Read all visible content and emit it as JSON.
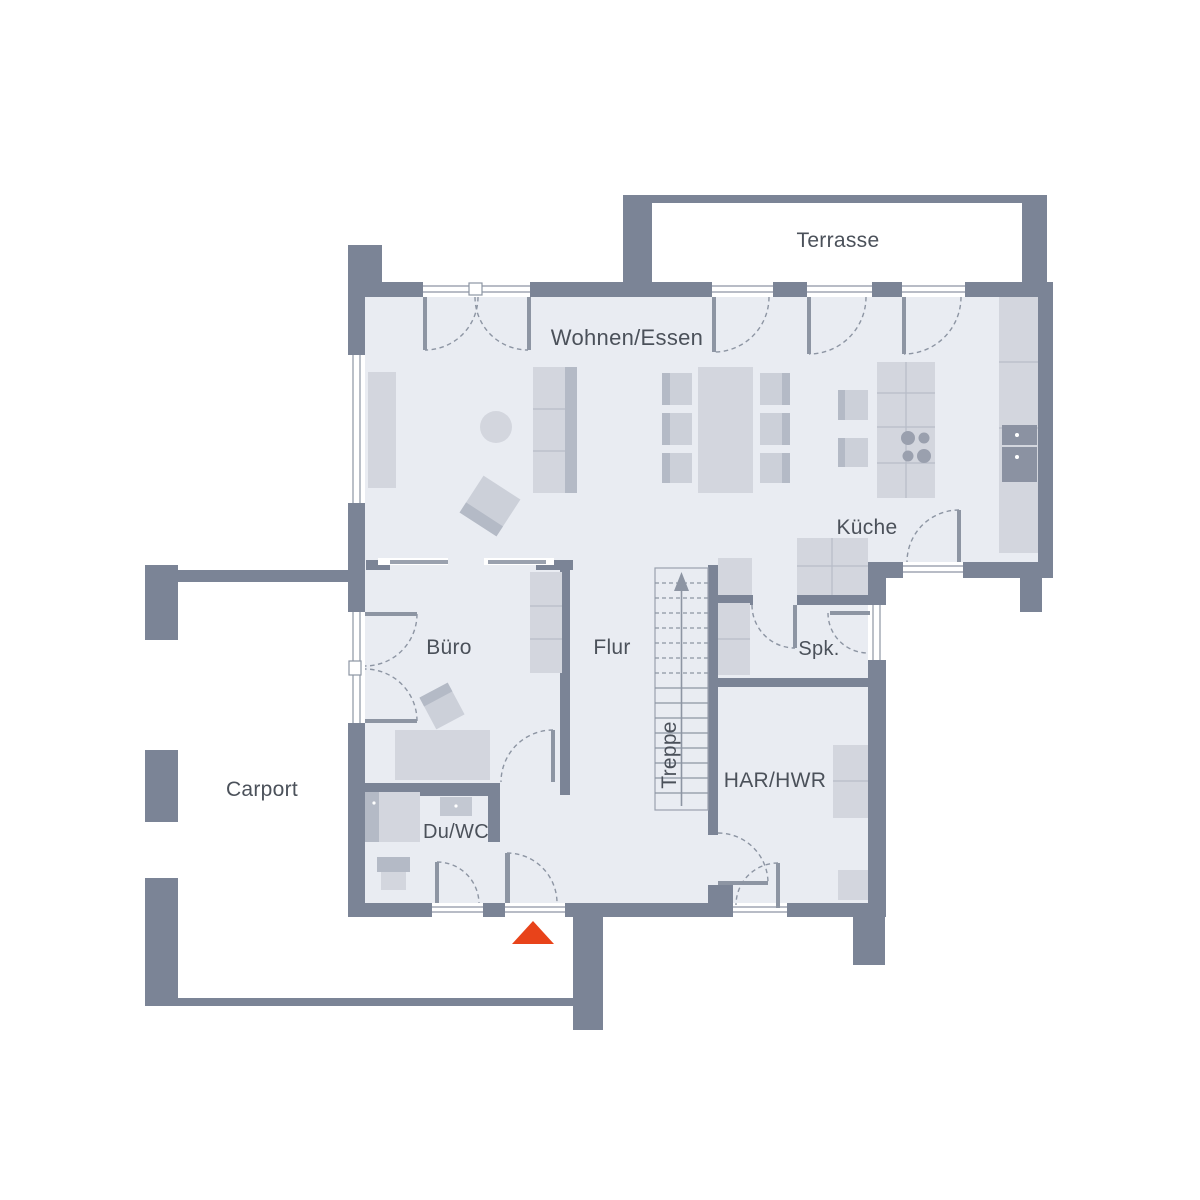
{
  "title": "Grundriss Erdgeschoss",
  "colors": {
    "background": "#ffffff",
    "wall": "#7b8496",
    "floor": "#e9ecf2",
    "furniture": "#d3d6de",
    "furniture_dark": "#b4bac6",
    "line": "#8d95a3",
    "text": "#4b515a",
    "accent": "#e8431a"
  },
  "rooms": [
    {
      "id": "terrasse",
      "label": "Terrasse"
    },
    {
      "id": "wohnen-essen",
      "label": "Wohnen/Essen"
    },
    {
      "id": "kueche",
      "label": "Küche"
    },
    {
      "id": "buero",
      "label": "Büro"
    },
    {
      "id": "flur",
      "label": "Flur"
    },
    {
      "id": "treppe",
      "label": "Treppe"
    },
    {
      "id": "spk",
      "label": "Spk."
    },
    {
      "id": "har-hwr",
      "label": "HAR/HWR"
    },
    {
      "id": "du-wc",
      "label": "Du/WC"
    },
    {
      "id": "carport",
      "label": "Carport"
    }
  ],
  "marker": {
    "name": "entrance-marker",
    "color": "#e8431a"
  }
}
